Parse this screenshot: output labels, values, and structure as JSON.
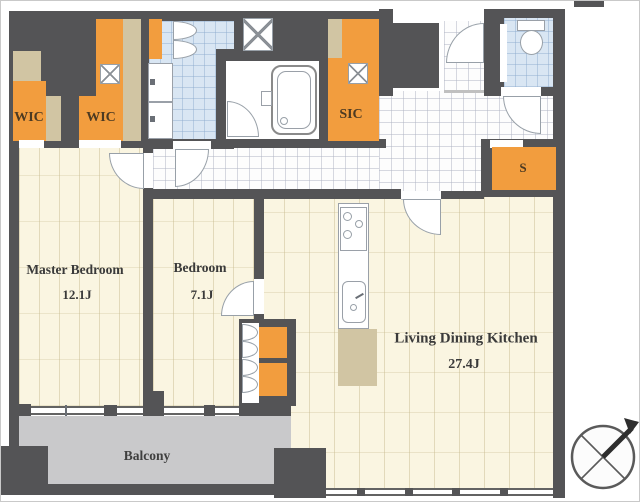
{
  "title": "apartment-floor-plan",
  "rooms": {
    "master_bedroom": {
      "label": "Master Bedroom",
      "area": "12.1J"
    },
    "bedroom": {
      "label": "Bedroom",
      "area": "7.1J"
    },
    "ldk": {
      "label": "Living Dining Kitchen",
      "area": "27.4J"
    },
    "balcony": {
      "label": "Balcony"
    },
    "wic_left": {
      "label": "WIC"
    },
    "wic_right": {
      "label": "WIC"
    },
    "sic": {
      "label": "SIC"
    },
    "storage": {
      "label": "S"
    }
  },
  "colors": {
    "wall": "#545456",
    "closet_orange": "#f29d3e",
    "counter_tan": "#d1c5a3",
    "bedroom_floor": "#faf5e1",
    "hall_tile": "#fdfdfd",
    "wet_area_blue": "#d9e6f3",
    "balcony_gray": "#c9c9cb",
    "label_brown": "#4c3a22"
  },
  "icons": [
    "compass-icon",
    "washing-machine-pan-icon",
    "toilet-icon",
    "bathtub-icon",
    "stove-icon",
    "kitchen-sink-icon",
    "vanity-sink-icon"
  ]
}
